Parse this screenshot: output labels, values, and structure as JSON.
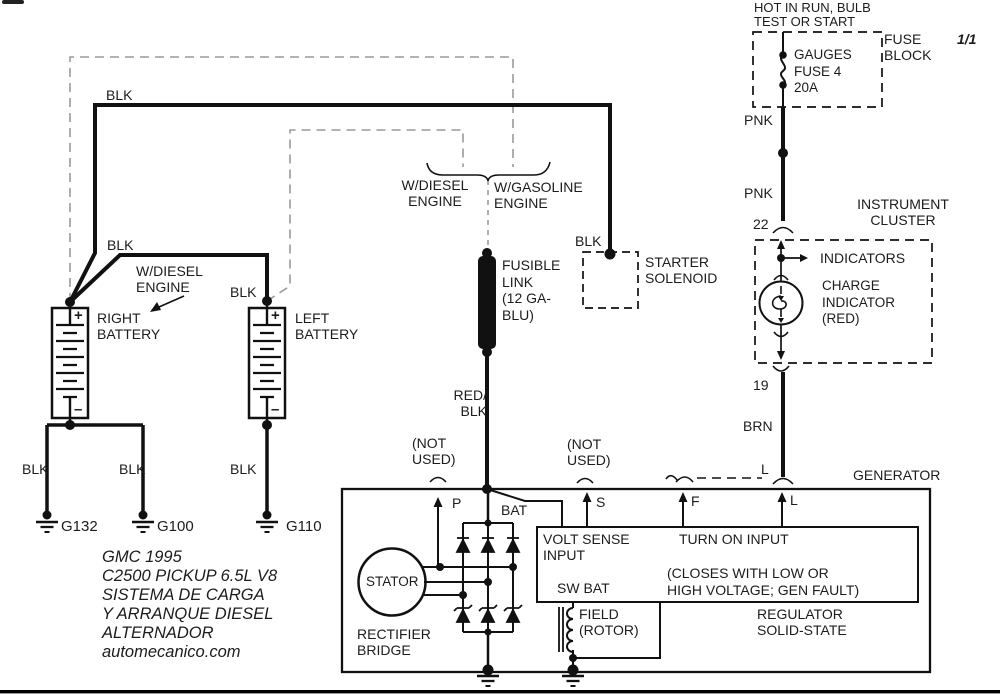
{
  "fuse_block": {
    "hot_label": "HOT IN RUN, BULB\nTEST OR START",
    "title": "FUSE\nBLOCK",
    "fuse_label": "GAUGES\nFUSE 4\n20A",
    "page_indicator": "1/1"
  },
  "wire_labels": {
    "blk": "BLK",
    "pnk": "PNK",
    "brn": "BRN",
    "red_blk": "RED/\nBLK"
  },
  "connectors": {
    "c22": "22",
    "c19": "19",
    "l_plug": "L"
  },
  "instrument_cluster": {
    "title": "INSTRUMENT\nCLUSTER",
    "indicators": "INDICATORS",
    "charge_indicator": "CHARGE\nINDICATOR\n(RED)"
  },
  "starter_solenoid": {
    "label": "STARTER\nSOLENOID"
  },
  "fusible_link": {
    "label": "FUSIBLE\nLINK\n(12 GA-\nBLU)"
  },
  "engine_split": {
    "diesel": "W/DIESEL\nENGINE",
    "gasoline": "W/GASOLINE\nENGINE"
  },
  "batteries": {
    "right": "RIGHT\nBATTERY",
    "left": "LEFT\nBATTERY",
    "diesel_note": "W/DIESEL\nENGINE",
    "plus": "+",
    "minus": "–"
  },
  "grounds": {
    "g132": "G132",
    "g100": "G100",
    "g110": "G110"
  },
  "generator": {
    "title": "GENERATOR",
    "terminal_p": "P",
    "terminal_s": "S",
    "terminal_f": "F",
    "terminal_l": "L",
    "bat": "BAT",
    "not_used": "(NOT\nUSED)",
    "volt_sense": "VOLT SENSE\nINPUT",
    "turn_on": "TURN ON INPUT",
    "closes_note": "(CLOSES WITH LOW OR\nHIGH VOLTAGE; GEN FAULT)",
    "sw_bat": "SW BAT",
    "field": "FIELD\n(ROTOR)",
    "regulator": "REGULATOR\nSOLID-STATE",
    "stator": "STATOR",
    "rectifier": "RECTIFIER\nBRIDGE"
  },
  "credit": "GMC  1995\nC2500 PICKUP 6.5L V8\nSISTEMA DE CARGA\nY ARRANQUE  DIESEL\nALTERNADOR\nautomecanico.com",
  "colors": {
    "line": "#1a1a1a",
    "dashed_optional": "#9a9a9a",
    "background": "#ffffff"
  }
}
